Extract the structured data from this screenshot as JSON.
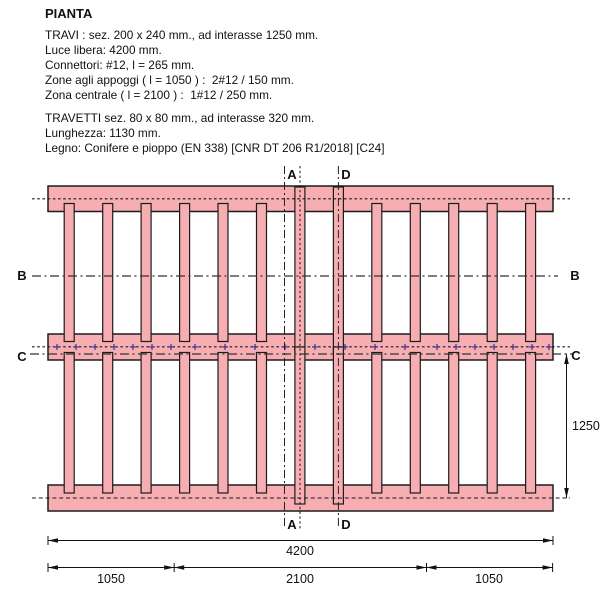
{
  "title": "PIANTA",
  "notes_travi": [
    "TRAVI : sez. 200 x 240 mm., ad interasse 1250 mm.",
    "Luce libera: 4200 mm.",
    "Connettori: #12, l = 265 mm.",
    "Zone agli appoggi ( l = 1050 ) :  2#12 / 150 mm.",
    "Zona centrale ( l = 2100 ) :  1#12 / 250 mm."
  ],
  "notes_travetti": [
    "TRAVETTI sez. 80 x 80 mm., ad interasse 320 mm.",
    "Lunghezza: 1130 mm.",
    "Legno: Conifere e pioppo (EN 338) [CNR DT 206 R1/2018] [C24]"
  ],
  "section_labels": {
    "a": "A",
    "b": "B",
    "c": "C",
    "d": "D"
  },
  "dimensions": {
    "total": "4200",
    "segment_left": "1050",
    "segment_center": "2100",
    "segment_right": "1050",
    "beam_spacing": "1250"
  },
  "colors": {
    "beam_fill": "#f6aeb2",
    "beam_outline": "#1c1c1c",
    "connector_mark": "#2b2b8f"
  }
}
